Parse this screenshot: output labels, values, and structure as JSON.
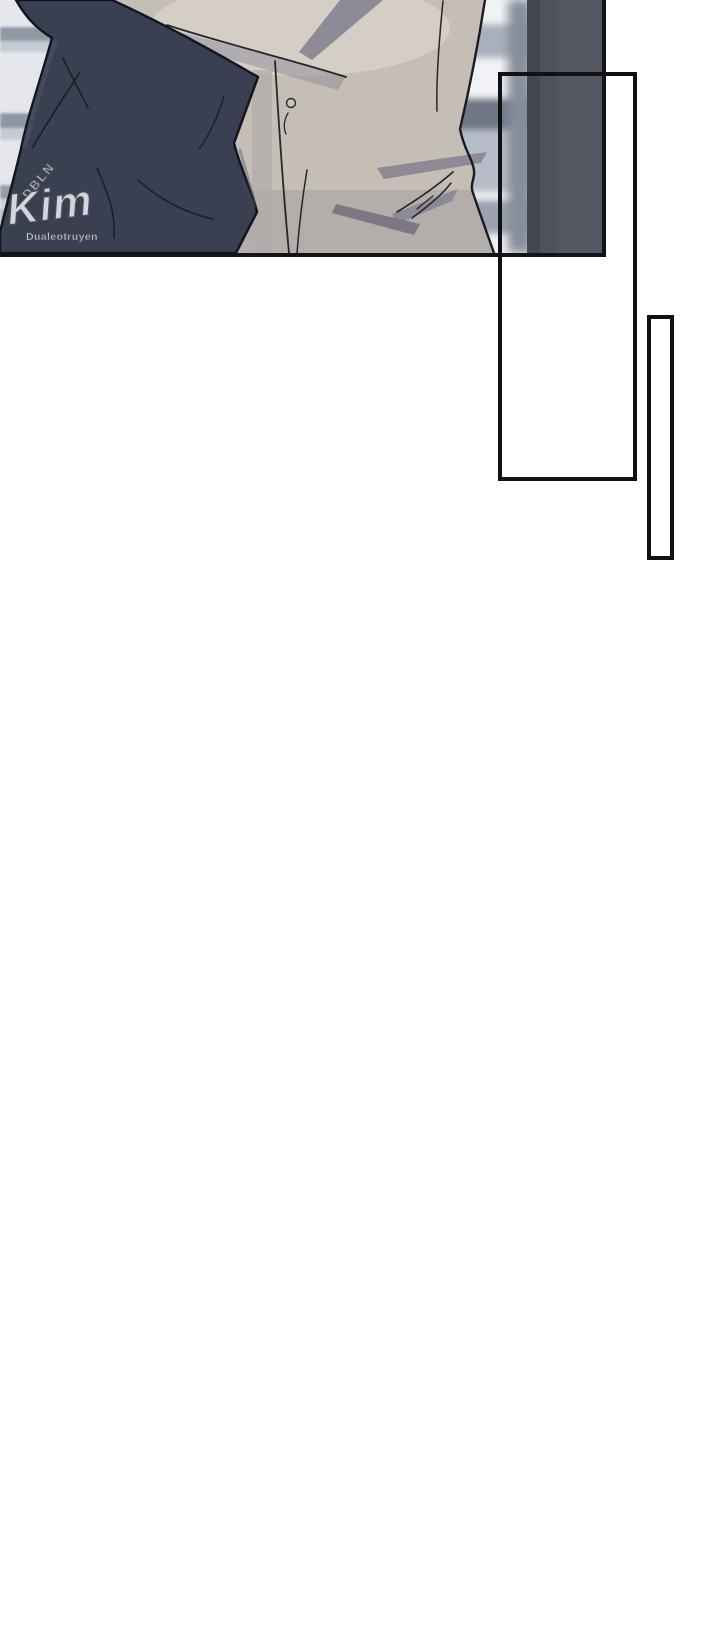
{
  "page": {
    "background_color": "#ffffff",
    "width_px": 720,
    "height_px": 1647
  },
  "panel": {
    "type": "comic-illustration",
    "watermark": {
      "group": "DBLN",
      "logo": "Kim",
      "site": "Dualeotruyen"
    },
    "colors": {
      "panel_border": "#131318",
      "frame_border": "#101015",
      "illustration_background": "#eff0f3",
      "dark_garment": "#3a4051",
      "garment_linework": "#14161f",
      "shirt_base": "#c4beb5",
      "shirt_highlight": "#ddd7cc",
      "shirt_shadow": "#8e8a96",
      "window_frame": "#4e525a",
      "blinds_light": "#e4e6eb",
      "blinds_dark": "#9098a6",
      "watermark_fill": "#fafafc",
      "watermark_outline": "#54565f"
    }
  }
}
